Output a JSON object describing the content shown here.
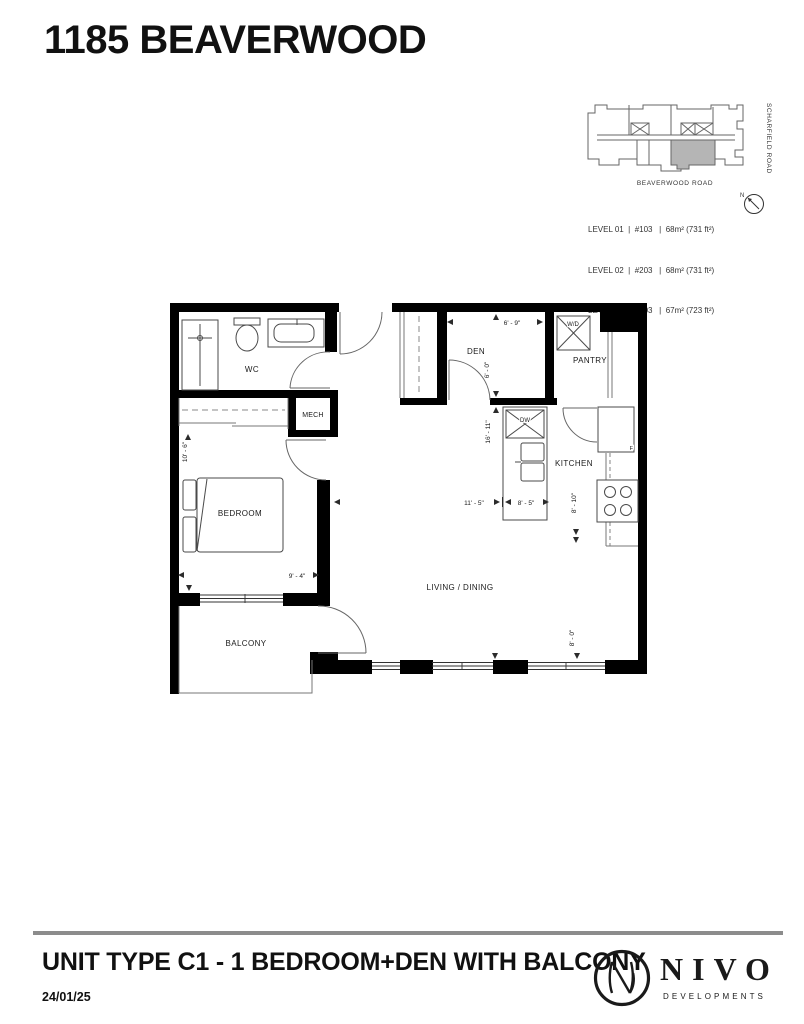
{
  "header": {
    "title": "1185 BEAVERWOOD"
  },
  "key_plan": {
    "road_bottom": "BEAVERWOOD ROAD",
    "road_right": "SCHARFIELD ROAD",
    "north_label": "N",
    "unit_fill": "#b5b5b5",
    "levels": [
      {
        "text": "LEVEL 01  |  #103   |  68m² (731 ft²)"
      },
      {
        "text": "LEVEL 02  |  #203   |  68m² (731 ft²)"
      },
      {
        "text": "LEVEL 03  |  #303   |  67m² (723 ft²)"
      }
    ]
  },
  "floor_plan": {
    "rooms": {
      "wc": "WC",
      "mech": "MECH",
      "bedroom": "BEDROOM",
      "balcony": "BALCONY",
      "den": "DEN",
      "pantry": "PANTRY",
      "kitchen": "KITCHEN",
      "living": "LIVING / DINING"
    },
    "appliances": {
      "washer_dryer": "W/D",
      "dishwasher": "DW",
      "fridge": "F"
    },
    "dimensions": {
      "den_width": "6' - 9\"",
      "den_height": "6' - 0\"",
      "hall_height": "16' - 11\"",
      "living_width": "11' - 5\"",
      "island_width": "8' - 5\"",
      "kitchen_height": "8' - 10\"",
      "window_height": "8' - 0\"",
      "bedroom_height": "10' - 6\"",
      "bedroom_width": "9' - 4\""
    }
  },
  "footer": {
    "unit_title": "UNIT TYPE C1 - 1 BEDROOM+DEN WITH BALCONY",
    "date": "24/01/25",
    "brand_name": "NIVO",
    "brand_tagline": "DEVELOPMENTS"
  }
}
